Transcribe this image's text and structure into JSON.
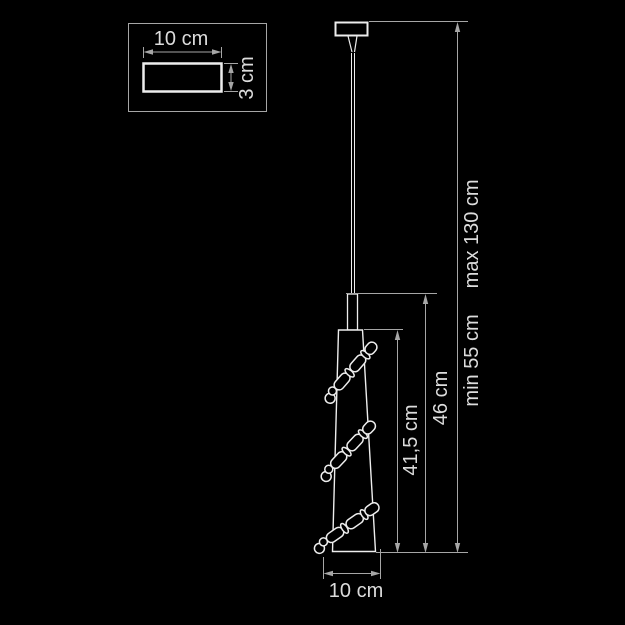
{
  "colors": {
    "background": "#000000",
    "outline": "#ededed",
    "dimension_line": "#a6a6a6",
    "label_text": "#dcdcdc"
  },
  "inset": {
    "width_label": "10 cm",
    "depth_label": "3 cm"
  },
  "main_dimensions": {
    "shade_height_label": "41,5 cm",
    "fixture_height_label": "46 cm",
    "suspension_min_label": "min 55 cm",
    "suspension_max_label": "max 130 cm",
    "shade_width_label": "10 cm"
  }
}
